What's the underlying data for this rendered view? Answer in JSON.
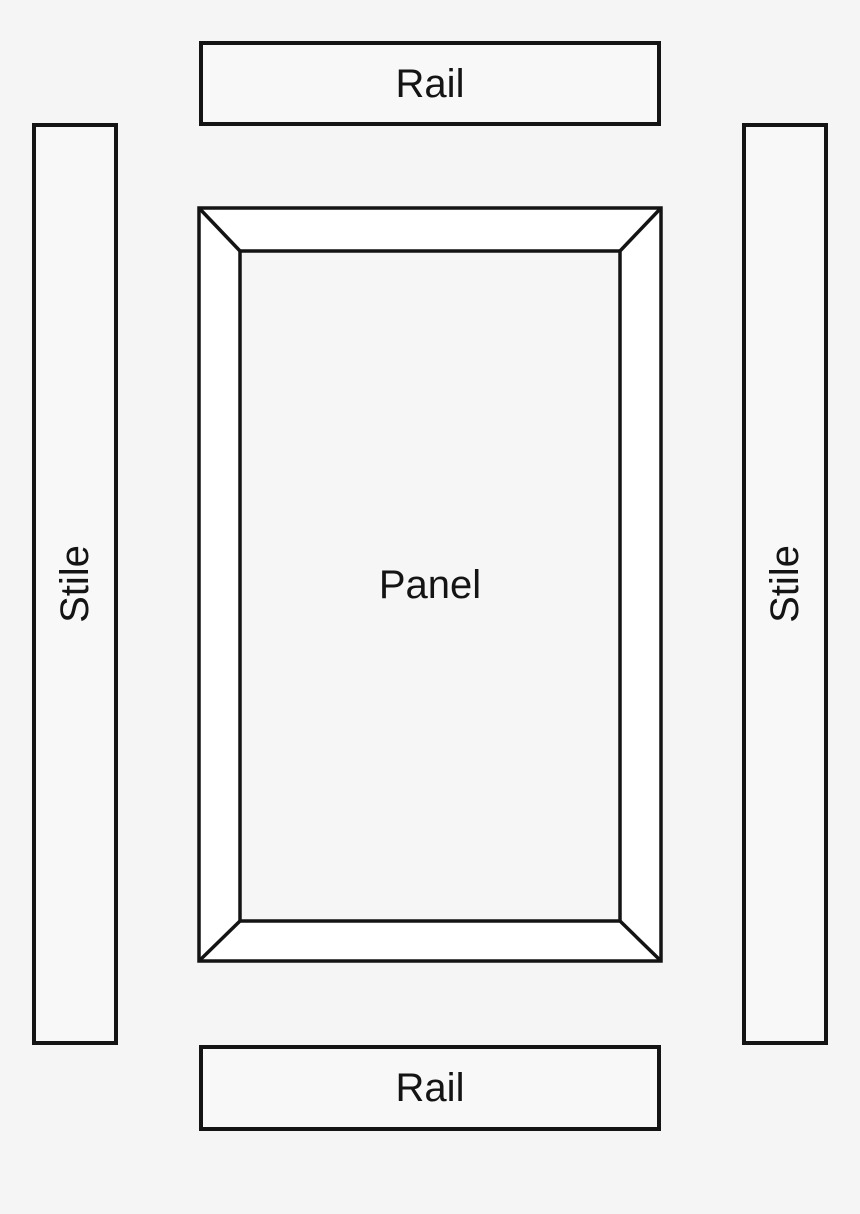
{
  "diagram": {
    "labels": {
      "top_rail": "Rail",
      "bottom_rail": "Rail",
      "left_stile": "Stile",
      "right_stile": "Stile",
      "panel": "Panel"
    },
    "colors": {
      "background": "#f5f5f5",
      "outline": "#141414",
      "member_fill": "#f8f8f8",
      "bevel_fill": "#ffffff",
      "panel_fill": "#f6f6f6"
    }
  }
}
